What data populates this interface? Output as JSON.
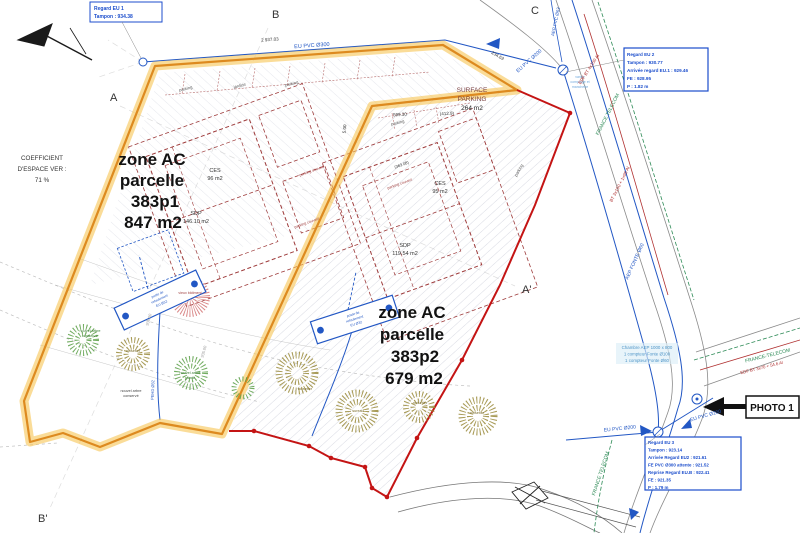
{
  "plan": {
    "section_labels": {
      "a": "A",
      "b": "B",
      "c": "C",
      "a2": "A'",
      "b2": "B'"
    },
    "coefficient": {
      "l1": "COEFFICIENT",
      "l2": "D'ESPACE VER :",
      "l3": "71 %"
    },
    "parcel1": {
      "zone": "zone  AC",
      "parcelle": "parcelle",
      "numero": "383p1",
      "surface": "847 m2",
      "ces": "CES",
      "ces_val": "96 m2",
      "sdp": "SDP",
      "sdp_val": "146.10 m2"
    },
    "parcel2": {
      "zone": "zone  AC",
      "parcelle": "parcelle",
      "numero": "383p2",
      "surface": "679 m2",
      "ces": "CES",
      "ces_val": "95 m2",
      "sdp": "SDP",
      "sdp_val": "119.54 m2"
    },
    "surface_parking": {
      "l1": "SURFACE",
      "l2": "PARKING",
      "l3": "264 m2"
    },
    "photo": {
      "label": "PHOTO 1"
    },
    "notes": {
      "eu1": {
        "l1": "Regard EU 1",
        "l2": "Tampon : 934.38"
      },
      "eu2": {
        "l1": "Regard EU 2",
        "l2": "Tampon : 930.77",
        "l3": "Arrivée regard EU.1 : 929.46",
        "l4": "FE : 928.95",
        "l5": "P : 1.82 m"
      },
      "eu3": {
        "l1": "Regard EU 3",
        "l2": "Tampon : 923.14",
        "l3": "Arrivée Regard EU2 : 921.61",
        "l4": "FE PVC Ø300 attente : 921.52",
        "l5": "Reprise Regard EU.B : 922.41",
        "l6": "FE : 921.35",
        "l7": "P : 1.79 m"
      },
      "chambre": {
        "l1": "Chambre AEP 1000 x 800",
        "l2": "1 compteur Fonte Ø100",
        "l3": "1 compteur Fonte Ø60"
      },
      "pompe": {
        "l1": "poste de",
        "l2": "refoulement",
        "l3": "EU Ø32"
      },
      "vanne": {
        "l1": "vanne",
        "l2": "comptage et",
        "l3": "manchette"
      }
    },
    "reseaux": {
      "eu300": "EU PVC Ø300",
      "eu200": "EU PVC Ø200",
      "aep63": "AEP PVC Ø63",
      "aep60": "AEP FONTE Ø60",
      "ft": "FRANCE TELECOM",
      "ft_tiret": "FRANCE-TELECOM",
      "edf_haut": "EDF BT 4x150 Al",
      "edf_mid": "BT 3x150 + 1x95 Al",
      "edf_droite": "EDF BT 3x70 + 54.6 Al",
      "pehd": "PEHD Ø32"
    },
    "cotes": {
      "c1": "2 937.03",
      "c2": "234.63",
      "c3": "599.30",
      "c4": "(412.9)",
      "c5": "5.00",
      "c6": "(363.08)"
    },
    "labels": {
      "parking": "parking",
      "parking_couvert": "parking couvert",
      "jardins": "jardins",
      "ruine": "vieux bâtiment"
    },
    "arbres": {
      "conserve1": "nouvel arbre",
      "conserve2": "conservé",
      "plante1": "nouvel arbre",
      "plante2": "planté",
      "noisetier": "noisetier",
      "sureau": "sureau"
    },
    "courbes": {
      "n936": "936.00",
      "n935": "935.00"
    },
    "colors": {
      "parcel1_outline": "#F2B33D",
      "parcel1_core": "#DD8A1F",
      "parcel2_outline": "#C41414",
      "reseau_eau": "#2257C4",
      "reseau_ft": "#2E8B57",
      "reseau_edf": "#B03030",
      "batiment": "#9E3B3B"
    }
  }
}
